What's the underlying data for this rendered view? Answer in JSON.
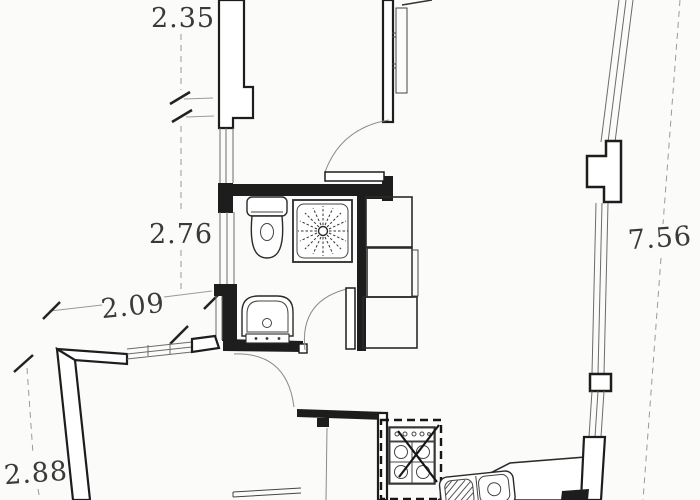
{
  "plan": {
    "type": "apartment-floor-plan",
    "colors": {
      "background": "#fbfbf9",
      "wall_ink": "#1d1d1d",
      "thin_line": "#6b6b6b",
      "dimension_text": "#3a3a3a"
    },
    "dimensions": {
      "top_width": "2.35",
      "bathroom_height": "2.76",
      "living_width": "2.09",
      "living_side": "2.88",
      "right_side": "7.56"
    }
  }
}
